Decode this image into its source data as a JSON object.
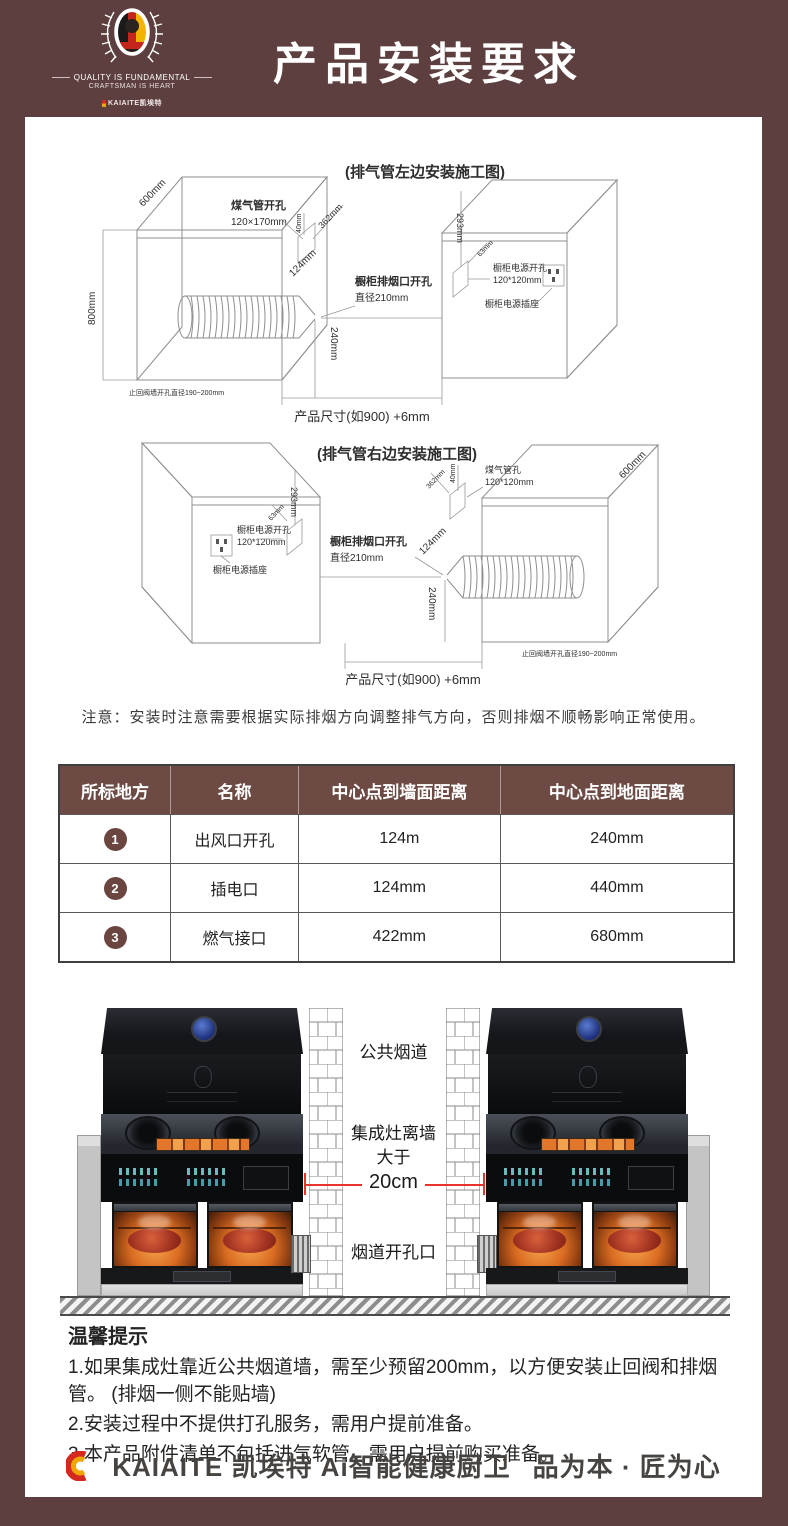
{
  "header": {
    "title": "产品安装要求",
    "motto1": "QUALITY IS FUNDAMENTAL",
    "motto2": "CRAFTSMAN IS HEART",
    "brand_small": "KAIAITE凯埃特"
  },
  "diagram_left": {
    "title": "(排气管左边安装施工图)",
    "dim_depth": "600mm",
    "dim_height": "800mm",
    "gas_label1": "煤气管开孔",
    "gas_label2": "120×170mm",
    "gas_dim1": "40mm",
    "gas_dim2": "362mm",
    "vent_label1": "橱柜排烟口开孔",
    "vent_label2": "直径210mm",
    "vent_dim1": "124mm",
    "vent_dim2": "240mm",
    "power_label1": "橱柜电源开孔",
    "power_label2": "120*120mm",
    "power_socket": "橱柜电源插座",
    "power_dim1": "293mm",
    "power_dim2": "63mm",
    "valve_note": "止回阀墙开孔直径190~200mm",
    "size_note": "产品尺寸(如900) +6mm"
  },
  "diagram_right": {
    "title": "(排气管右边安装施工图)",
    "dim_depth": "600mm",
    "gas_label1": "煤气管孔",
    "gas_label2": "120*120mm",
    "gas_dim1": "40mm",
    "gas_dim2": "362mm",
    "vent_label1": "橱柜排烟口开孔",
    "vent_label2": "直径210mm",
    "vent_dim1": "124mm",
    "vent_dim2": "240mm",
    "power_label1": "橱柜电源开孔",
    "power_label2": "120*120mm",
    "power_socket": "橱柜电源插座",
    "power_dim1": "293mm",
    "power_dim2": "63mm",
    "valve_note": "止回阀墙开孔直径190~200mm",
    "size_note": "产品尺寸(如900) +6mm"
  },
  "notice": "注意：安装时注意需要根据实际排烟方向调整排气方向，否则排烟不顺畅影响正常使用。",
  "table": {
    "headers": [
      "所标地方",
      "名称",
      "中心点到墙面距离",
      "中心点到地面距离"
    ],
    "rows": [
      {
        "num": "1",
        "name": "出风口开孔",
        "wall": "124m",
        "floor": "240mm"
      },
      {
        "num": "2",
        "name": "插电口",
        "wall": "124mm",
        "floor": "440mm"
      },
      {
        "num": "3",
        "name": "燃气接口",
        "wall": "422mm",
        "floor": "680mm"
      }
    ]
  },
  "install": {
    "flue": "公共烟道",
    "gap_line1": "集成灶离墙",
    "gap_line2": "大于",
    "gap_line3": "20cm",
    "opening": "烟道开孔口"
  },
  "tips": {
    "title": "温馨提示",
    "items": [
      "1.如果集成灶靠近公共烟道墙，需至少预留200mm，以方便安装止回阀和排烟管。 (排烟一侧不能贴墙)",
      "2.安装过程中不提供打孔服务，需用户提前准备。",
      "3.本产品附件清单不包括进气软管，需用户提前购买准备。"
    ]
  },
  "footer": {
    "brand": "KAIAITE 凯埃特 Ai智能健康厨卫",
    "slogan": "品为本 · 匠为心"
  },
  "colors": {
    "background_maroon": "#5d3f3f",
    "table_header": "#6e4a44",
    "accent_red": "#e8342a",
    "display_orange": "#e2762a",
    "logo_blue": "#1d2f7a"
  }
}
